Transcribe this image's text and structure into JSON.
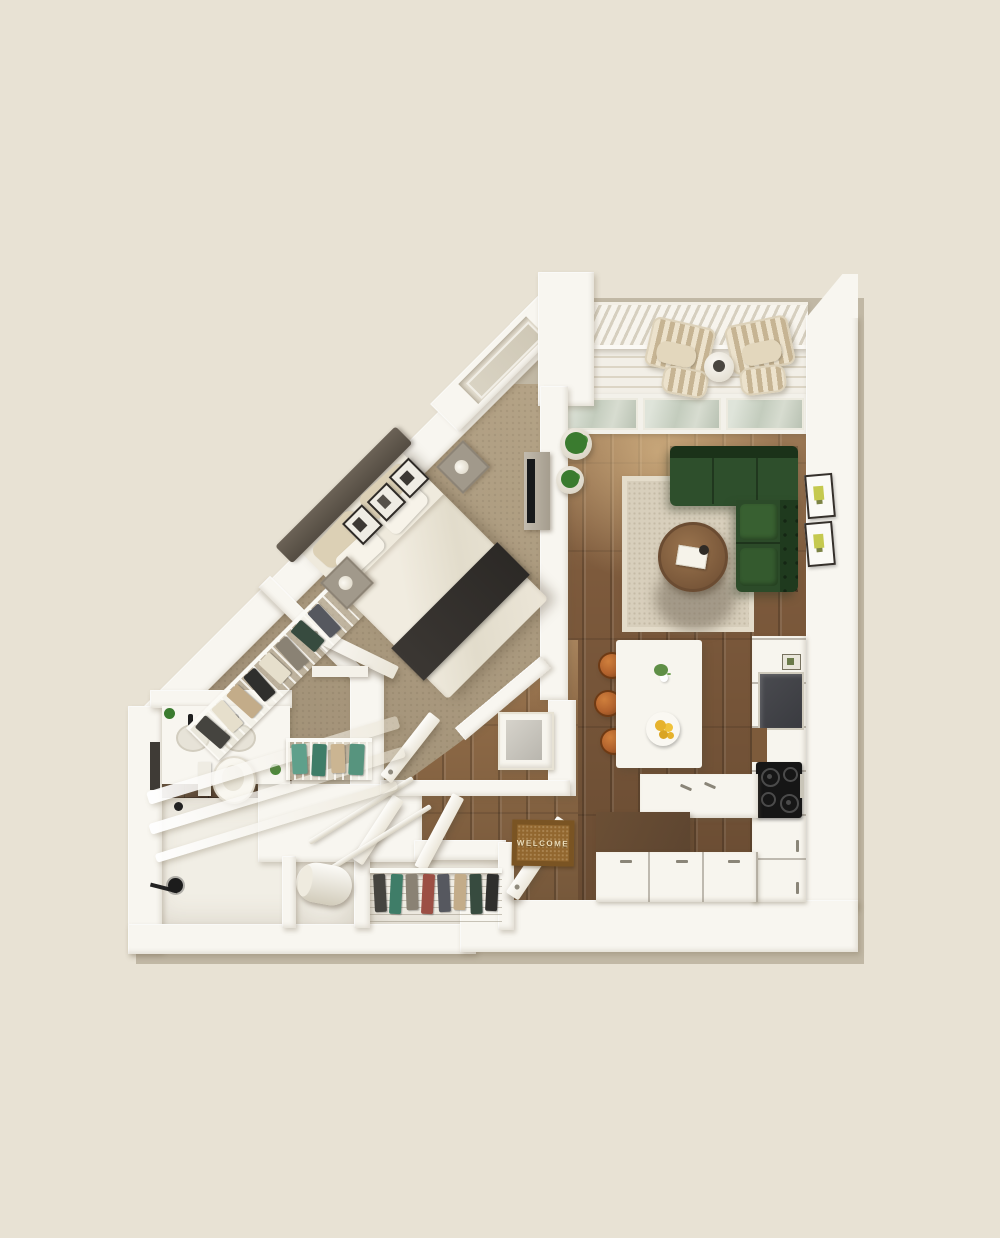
{
  "mat": {
    "text": "WELCOME"
  },
  "theme": {
    "bg": "#e8e2d4",
    "wall": "#f8f6f0",
    "wood": "#7d5a3c",
    "woodHall": "#8d6946",
    "carpet": "#b2a084",
    "rug": "#d8cfbc",
    "sofa": "#2e4f2c",
    "table": "#8a6544",
    "tile": "#5c4430",
    "bathFloor": "#f1eee5",
    "deck": "#eeebe1",
    "glass": "#c3ccbd",
    "stool": "#b2622d",
    "mat": "#92672f",
    "matBorder": "#7a5423",
    "teal": "#5fa08b",
    "plant": "#3a7b2f",
    "appliance": "#3a3b40",
    "counterDark": "#5d4530",
    "cooktop": "#161616"
  }
}
